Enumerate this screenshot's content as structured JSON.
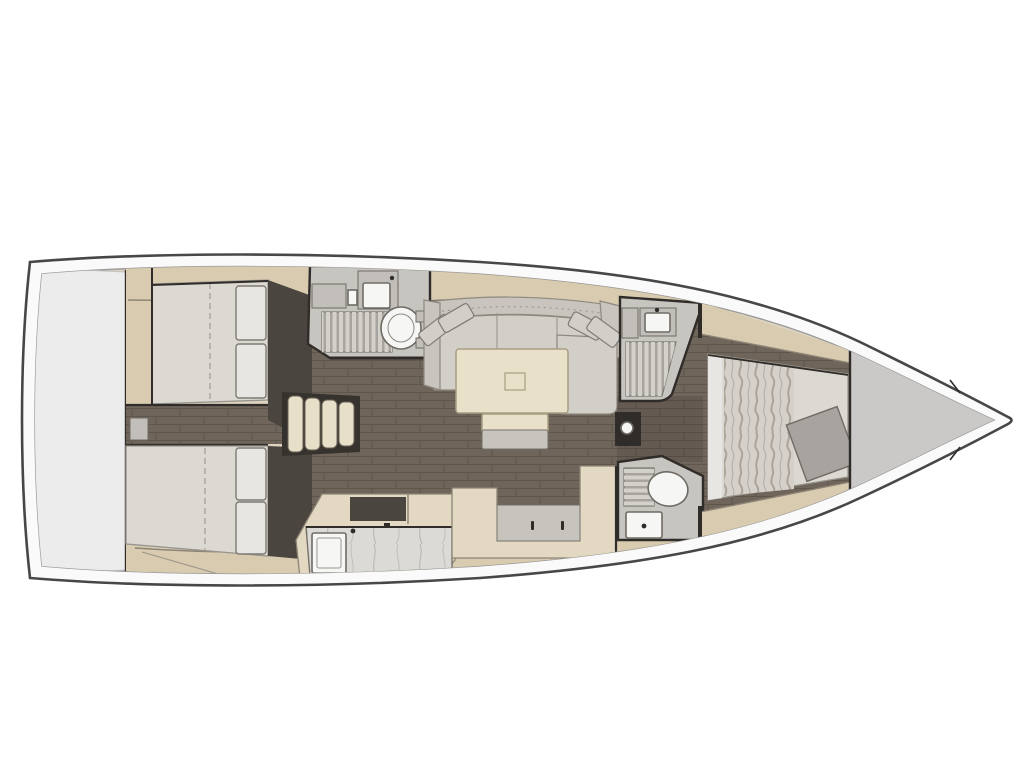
{
  "meta": {
    "type": "yacht-interior-floor-plan",
    "view": "top-down",
    "orientation": "bow-right"
  },
  "components": [
    "hull",
    "deck-band",
    "stern-locker",
    "aft-cabin-port",
    "aft-cabin-starboard",
    "companionway-steps",
    "saloon",
    "saloon-sofa",
    "saloon-table",
    "table-bench",
    "aft-head",
    "galley",
    "nav-seat",
    "forward-shower",
    "forward-head",
    "forward-cabin",
    "island-bed",
    "bow-locker",
    "mast-post"
  ],
  "palette": {
    "bg": "#ffffff",
    "hull-stroke": "#474747",
    "deck": "#fafafa",
    "inner-line": "#9b9b9b",
    "base-tan": "#ddd3bf",
    "band-tan": "#d8cbb0",
    "band-edge": "#8d8475",
    "floor": "#6f655a",
    "floor-line": "#5e554b",
    "wall": "#2f2c29",
    "entry-dark": "#4a453e",
    "stern-panel": "#ececec",
    "stern-edge": "#c2c2c2",
    "bow-panel": "#cbc9c7",
    "mattress": "#dcd9d3",
    "mattress-edge": "#98948d",
    "pillow": "#e8e6e2",
    "pillow-edge": "#7e7a74",
    "cushion": "#d2cfc8",
    "cushion-edge": "#8d897f",
    "sofa-back": "#c9c5be",
    "table": "#e9e0c9",
    "table-edge": "#a99d82",
    "bath-floor": "#c7c5c0",
    "grate-base": "#a8a5a0",
    "grate-slat": "#d4d1cb",
    "grate-edge": "#7b7772",
    "fixture": "#f6f6f4",
    "fixture-edge": "#6f6b65",
    "cab-gray": "#c2bfba",
    "marble": "#dcdad6",
    "marble-vein": "#b7b4b0",
    "marble-edge": "#75716b",
    "galley-tan": "#e3d8c1",
    "inset-gray": "#c7c4be",
    "steps": "#e8dfc9",
    "steps-bg": "#36322e",
    "steps-edge": "#6b6357",
    "throw": "#a7a4a0",
    "throw-edge": "#706d68",
    "seam": "#9b968d",
    "ruffle-base": "#d5d1ca",
    "ruffle-line": "#aaa49a"
  }
}
